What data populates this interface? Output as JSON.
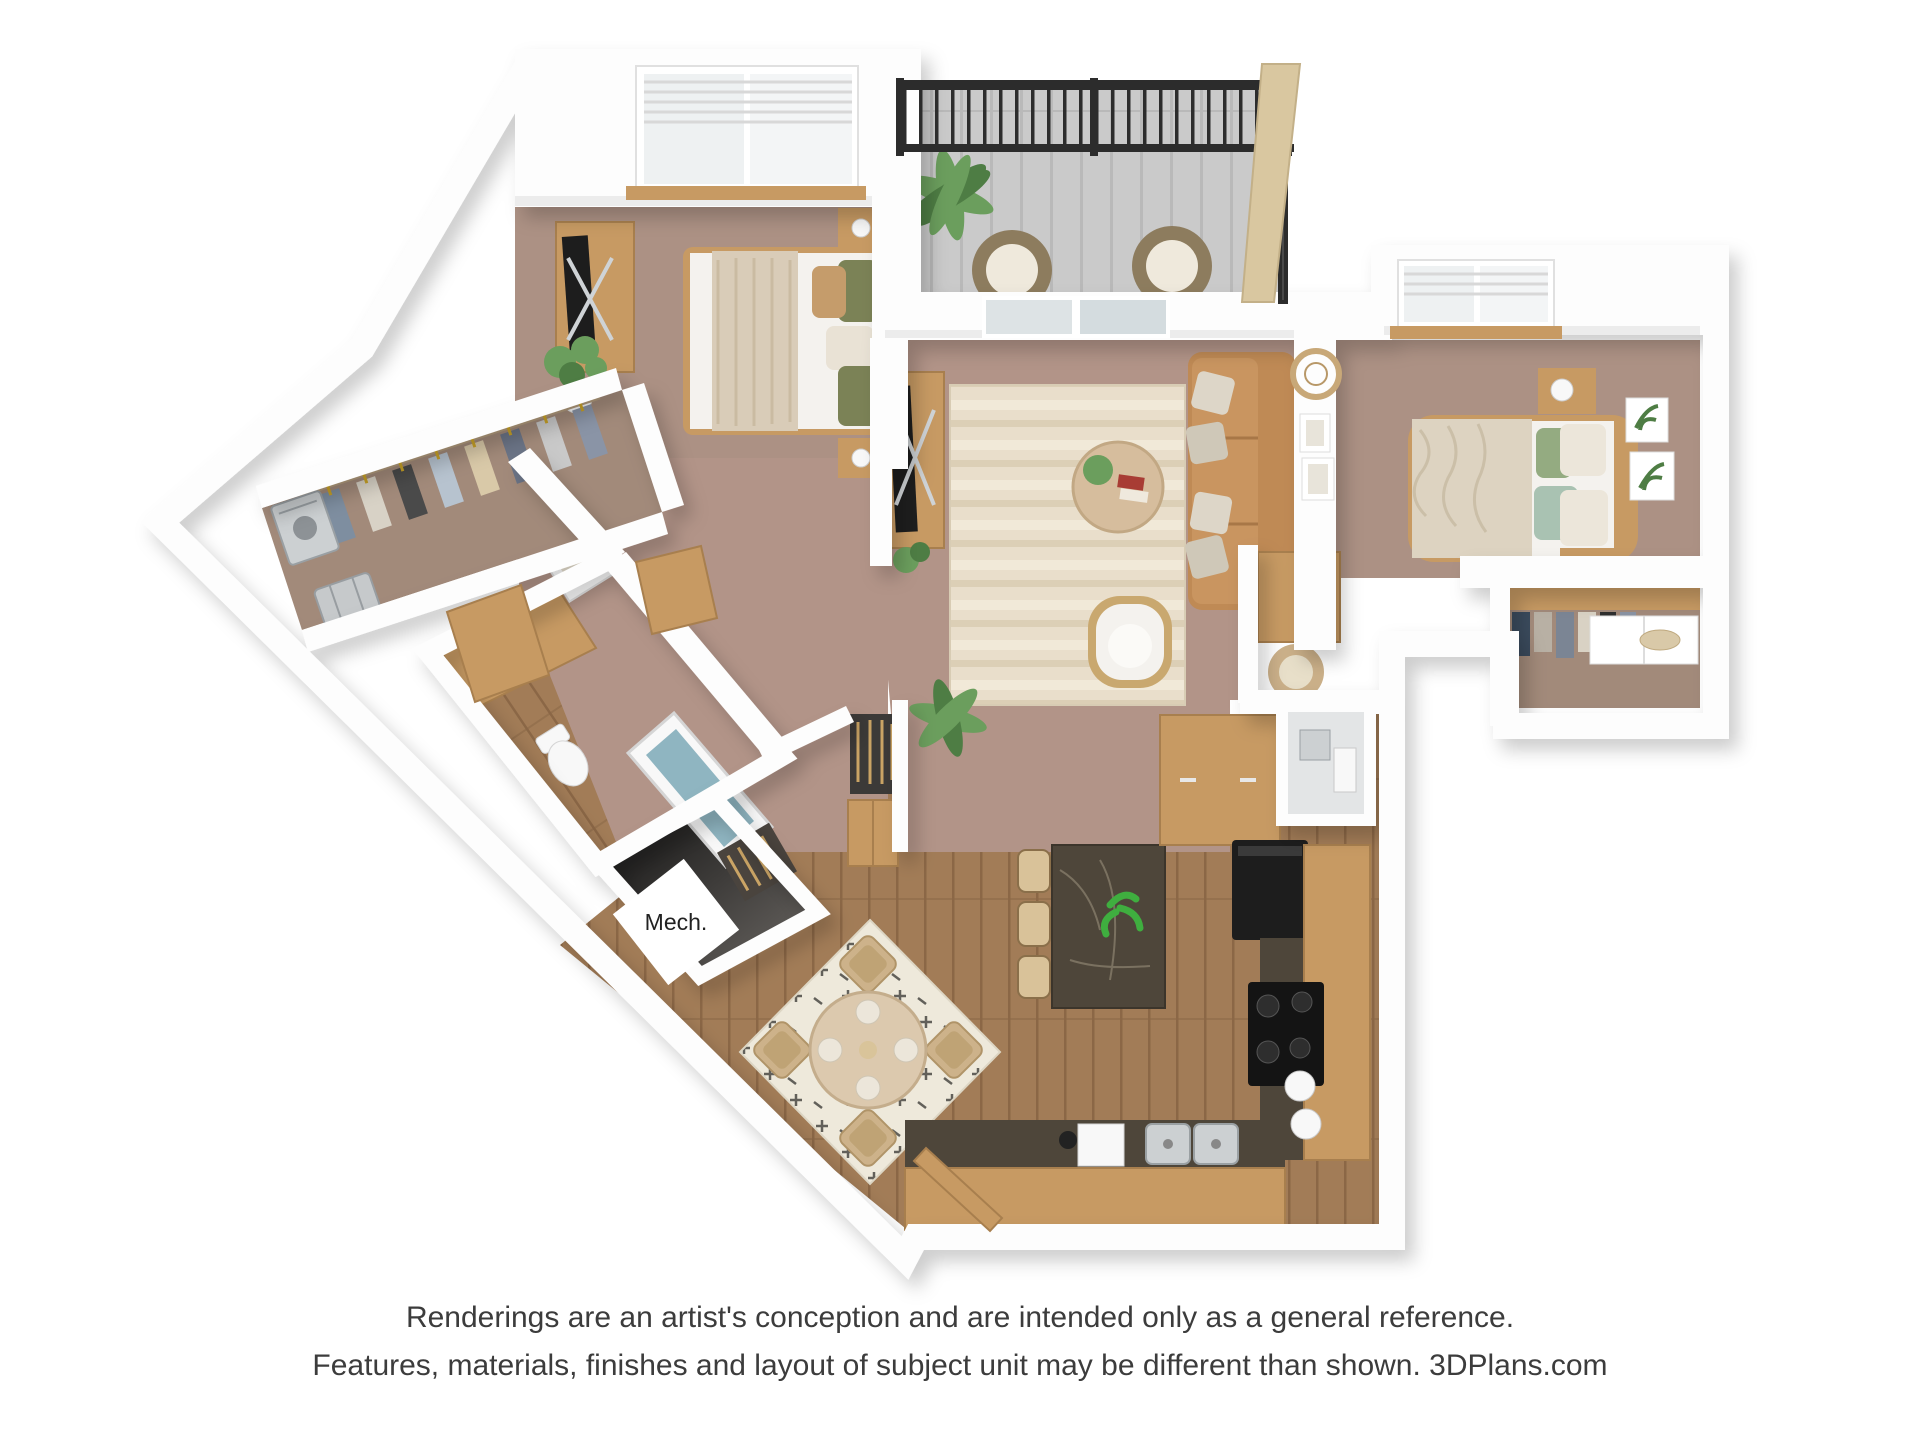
{
  "colors": {
    "background": "#ffffff",
    "wall": "#fdfdfd",
    "wallshade": "#ececec",
    "carpet": "#b29488",
    "carpet2": "#ac9184",
    "carpet3": "#a28a7a",
    "wood": "#a27c57",
    "woodline": "#8b6746",
    "trim": "#c79a63",
    "counter": "#4e463a",
    "sofa": "#bf8a55",
    "rug": "#e9decb",
    "rugband": "#dccfb6",
    "rug2": "#eee9db",
    "rugpattern": "#3f3d39",
    "balcony": "#cacaca",
    "deckline": "#b9b9b9",
    "railing": "#2c2c2c",
    "privacy": "#d9c7a0",
    "green": "#6b9e5d",
    "greendark": "#4e7d44",
    "linen": "#f4f2ee",
    "throw": "#d9ccb8",
    "comforter": "#ddd3c1",
    "olive": "#7b8256",
    "tanpillow": "#c59c6b",
    "sage": "#94ab81",
    "teal": "#a9c2b2",
    "dark": "#1d1d1d",
    "silver": "#ccd0d2",
    "whitefixture": "#f8f8f8",
    "water": "#8fb5c1",
    "gold": "#c9a227",
    "labeltext": "#222222",
    "text": "#3c3c3c"
  },
  "floorplan": {
    "mech_label": "Mech."
  },
  "disclaimer": {
    "line1": "Renderings are an artist's conception and are intended only as a general reference.",
    "line2": "Features, materials, finishes and layout of subject unit may be different than shown. 3DPlans.com"
  }
}
